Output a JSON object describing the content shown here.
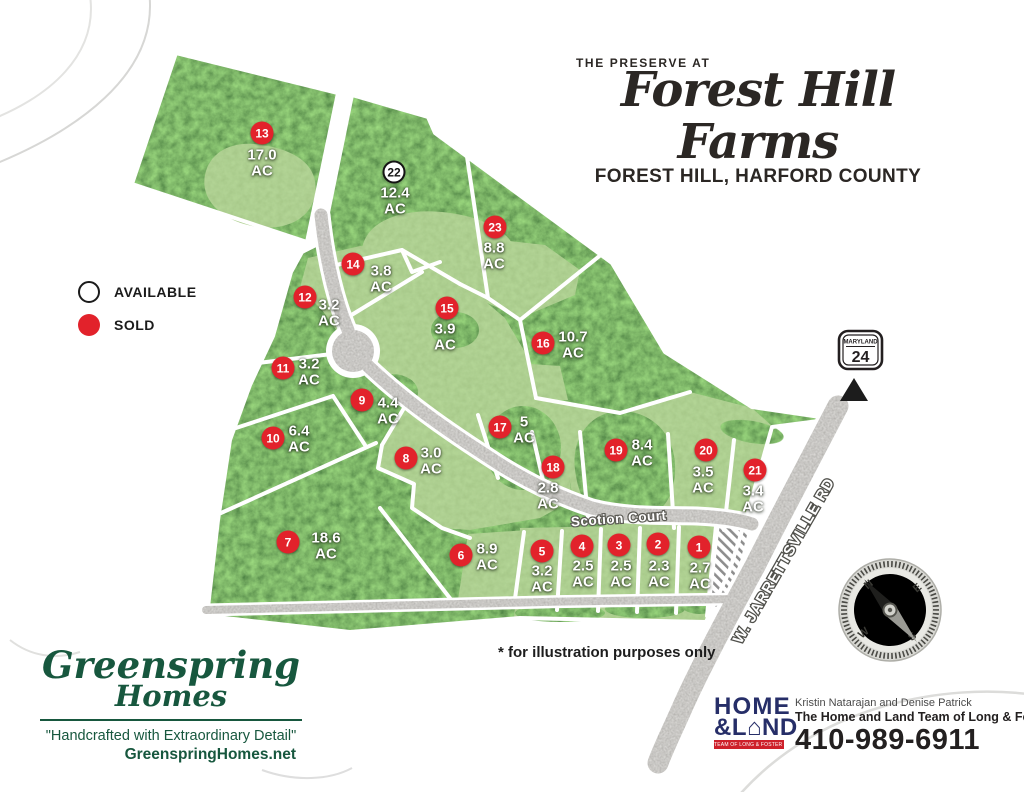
{
  "title": {
    "eyebrow": "THE PRESERVE AT",
    "script": "Forest Hill Farms",
    "subtitle": "FOREST HILL, HARFORD COUNTY"
  },
  "legend": {
    "available": "AVAILABLE",
    "sold": "SOLD"
  },
  "labels": {
    "acres_unit": "AC",
    "disclaimer": "* for illustration purposes only"
  },
  "roads": {
    "scotion": "Scotion Court",
    "jarrettsville": "W. JARRETTSVILLE RD"
  },
  "route_sign": {
    "state": "MARYLAND",
    "number": "24"
  },
  "compass": {
    "n": "N",
    "e": "E",
    "s": "S",
    "w": "W"
  },
  "map_lots": [
    {
      "number": "1",
      "acres": "2.7",
      "status": "sold",
      "bx": 699,
      "by": 547,
      "tx": 700,
      "ty": 576
    },
    {
      "number": "2",
      "acres": "2.3",
      "status": "sold",
      "bx": 658,
      "by": 544,
      "tx": 659,
      "ty": 574
    },
    {
      "number": "3",
      "acres": "2.5",
      "status": "sold",
      "bx": 619,
      "by": 545,
      "tx": 621,
      "ty": 574
    },
    {
      "number": "4",
      "acres": "2.5",
      "status": "sold",
      "bx": 582,
      "by": 546,
      "tx": 583,
      "ty": 574
    },
    {
      "number": "5",
      "acres": "3.2",
      "status": "sold",
      "bx": 542,
      "by": 551,
      "tx": 542,
      "ty": 579
    },
    {
      "number": "6",
      "acres": "8.9",
      "status": "sold",
      "bx": 461,
      "by": 555,
      "tx": 487,
      "ty": 557
    },
    {
      "number": "7",
      "acres": "18.6",
      "status": "sold",
      "bx": 288,
      "by": 542,
      "tx": 326,
      "ty": 546
    },
    {
      "number": "8",
      "acres": "3.0",
      "status": "sold",
      "bx": 406,
      "by": 458,
      "tx": 431,
      "ty": 461
    },
    {
      "number": "9",
      "acres": "4.4",
      "status": "sold",
      "bx": 362,
      "by": 400,
      "tx": 388,
      "ty": 411
    },
    {
      "number": "10",
      "acres": "6.4",
      "status": "sold",
      "bx": 273,
      "by": 438,
      "tx": 299,
      "ty": 439
    },
    {
      "number": "11",
      "acres": "3.2",
      "status": "sold",
      "bx": 283,
      "by": 368,
      "tx": 309,
      "ty": 372
    },
    {
      "number": "12",
      "acres": "3.2",
      "status": "sold",
      "bx": 305,
      "by": 297,
      "tx": 329,
      "ty": 313
    },
    {
      "number": "13",
      "acres": "17.0",
      "status": "sold",
      "bx": 262,
      "by": 133,
      "tx": 262,
      "ty": 163
    },
    {
      "number": "14",
      "acres": "3.8",
      "status": "sold",
      "bx": 353,
      "by": 264,
      "tx": 381,
      "ty": 279
    },
    {
      "number": "15",
      "acres": "3.9",
      "status": "sold",
      "bx": 447,
      "by": 308,
      "tx": 445,
      "ty": 337
    },
    {
      "number": "16",
      "acres": "10.7",
      "status": "sold",
      "bx": 543,
      "by": 343,
      "tx": 573,
      "ty": 345
    },
    {
      "number": "17",
      "acres": "5",
      "status": "sold",
      "bx": 500,
      "by": 427,
      "tx": 524,
      "ty": 430
    },
    {
      "number": "18",
      "acres": "2.8",
      "status": "sold",
      "bx": 553,
      "by": 467,
      "tx": 548,
      "ty": 496
    },
    {
      "number": "19",
      "acres": "8.4",
      "status": "sold",
      "bx": 616,
      "by": 450,
      "tx": 642,
      "ty": 453
    },
    {
      "number": "20",
      "acres": "3.5",
      "status": "sold",
      "bx": 706,
      "by": 450,
      "tx": 703,
      "ty": 480
    },
    {
      "number": "21",
      "acres": "3.4",
      "status": "sold",
      "bx": 755,
      "by": 470,
      "tx": 753,
      "ty": 499
    },
    {
      "number": "22",
      "acres": "12.4",
      "status": "available",
      "bx": 394,
      "by": 172,
      "tx": 395,
      "ty": 201
    },
    {
      "number": "23",
      "acres": "8.8",
      "status": "sold",
      "bx": 495,
      "by": 227,
      "tx": 494,
      "ty": 256
    }
  ],
  "greenspring": {
    "name_line1": "Greenspring",
    "name_line2": "Homes",
    "tagline": "\"Handcrafted with Extraordinary Detail\"",
    "website": "GreenspringHomes.net"
  },
  "homeland": {
    "logo_line1": "HOME",
    "logo_amp_l": "&L",
    "house_icon": "⌂",
    "logo_nd": "ND",
    "logo_banner": "TEAM OF LONG & FOSTER REAL ESTATE",
    "agents": "Kristin Natarajan and Denise Patrick",
    "team": "The Home and Land Team of Long & Foster",
    "phone": "410-989-6911"
  },
  "colors": {
    "sold_red": "#e2222b",
    "available_outline": "#1b1b1b",
    "clearing_green": "#6ba049",
    "forest_green": "#2f4d22",
    "road_gray": "#8f8e8a",
    "navy": "#262e68",
    "banner_red": "#ce202a",
    "brand_green": "#17573e"
  }
}
